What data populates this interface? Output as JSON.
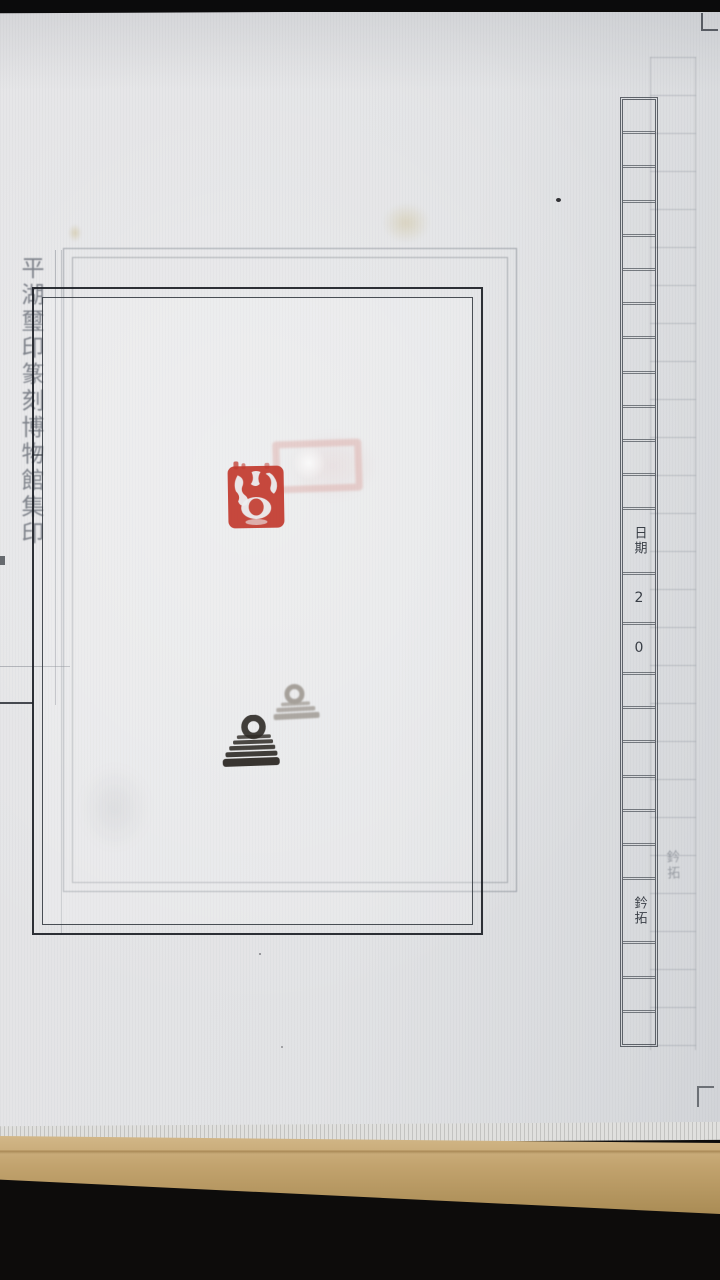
{
  "photo": {
    "description_labels": {
      "spine_label": "平湖璽印篆刻博物館集印",
      "ghost_column_label": "鈐拓"
    },
    "right_column": {
      "cells": [
        "",
        "",
        "",
        "",
        "",
        "",
        "",
        "",
        "",
        "",
        "",
        "",
        "日期",
        "2",
        "0",
        "",
        "",
        "",
        "",
        "",
        "",
        "鈐拓",
        "",
        "",
        ""
      ]
    },
    "colors": {
      "seal_red": "#c23a2e",
      "paper": "#e2e3e5",
      "board_tan": "#c2a36e",
      "background_black": "#0d0c0b",
      "frame_black": "#23262d",
      "frame_grey": "#737a84",
      "rubbing_ink": "#2e2a26"
    }
  }
}
